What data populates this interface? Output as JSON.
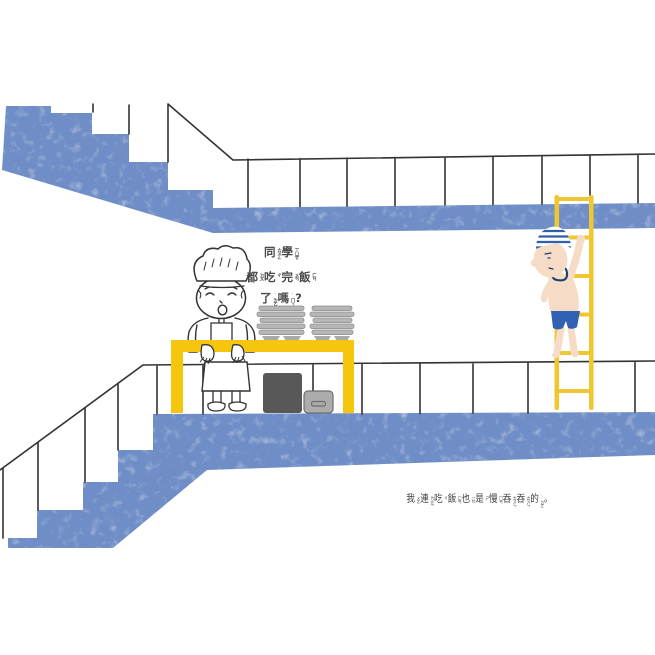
{
  "page": {
    "background_color": "#ffffff"
  },
  "speech": {
    "text_plain": "同學都吃完飯了嗎?",
    "lines": [
      [
        {
          "ch": "同",
          "zy": "ㄊㄨㄥˊ"
        },
        {
          "ch": "學",
          "zy": "ㄒㄩㄝˊ"
        }
      ],
      [
        {
          "ch": "都",
          "zy": "ㄉㄡ"
        },
        {
          "ch": "吃",
          "zy": "ㄔ"
        },
        {
          "ch": "完",
          "zy": "ㄨㄢˊ"
        },
        {
          "ch": "飯",
          "zy": "ㄈㄢˋ"
        }
      ],
      [
        {
          "ch": "了",
          "zy": "˙ㄌㄜ"
        },
        {
          "ch": "嗎",
          "zy": "˙ㄇㄚ"
        },
        {
          "ch": "?"
        }
      ]
    ]
  },
  "caption": {
    "text_plain": "我連吃飯也是慢吞吞的。",
    "units": [
      {
        "ch": "我",
        "zy": "ㄨㄛˇ"
      },
      {
        "ch": "連",
        "zy": "ㄌㄧㄢˊ"
      },
      {
        "ch": "吃",
        "zy": "ㄔ"
      },
      {
        "ch": "飯",
        "zy": "ㄈㄢˋ"
      },
      {
        "ch": "也",
        "zy": "ㄧㄝˇ"
      },
      {
        "ch": "是",
        "zy": "ㄕˋ"
      },
      {
        "ch": "慢",
        "zy": "ㄇㄢˋ"
      },
      {
        "ch": "吞",
        "zy": "ㄊㄨㄣ"
      },
      {
        "ch": "吞",
        "zy": "ㄊㄨㄣ"
      },
      {
        "ch": "的",
        "zy": "˙ㄉㄜ"
      },
      {
        "ch": "。"
      }
    ]
  },
  "colors": {
    "stair_blue": "#6f8dc6",
    "counter_yellow": "#f6c50e",
    "ladder_yellow": "#eec733",
    "trunks_blue": "#3061b2",
    "cap_stripe_blue": "#2e5fae",
    "swirl_navy": "#1e3d72",
    "skin": "#f6dcc6",
    "line": "#333333",
    "tray_grey": "#b6b6b6",
    "bowl_grey": "#a9a9a9",
    "bin_dark": "#585858",
    "bin_grey": "#acacac",
    "bin_line": "#6e6e6e",
    "text_grey": "#3f3f3f",
    "speech_grey": "#4a4a4a"
  }
}
